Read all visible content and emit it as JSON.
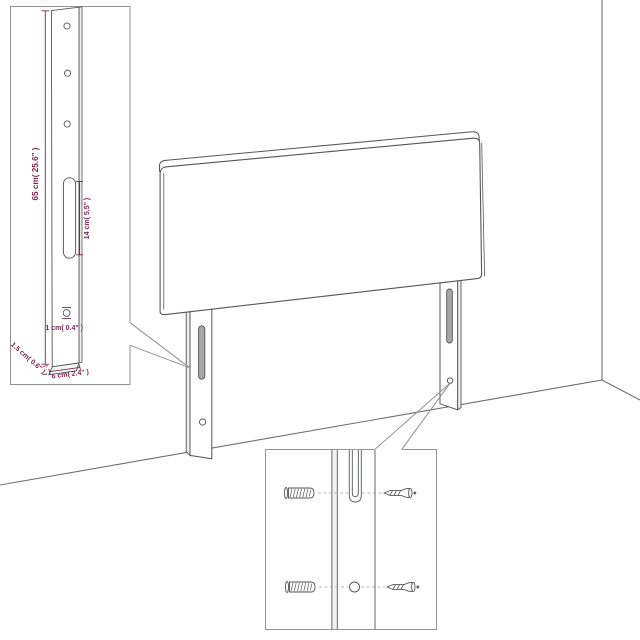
{
  "colors": {
    "background": "#ffffff",
    "object_line": "#55565a",
    "inset_border": "#919396",
    "callout_line": "#8f9194",
    "dimension": "#7c2950",
    "slot_fill": "#a8a8a8",
    "dashed_line": "#9b9b9b"
  },
  "leg_detail_inset": {
    "height_label": "65 cm( 25.6\" )",
    "slot_length_label": "14 cm( 5.5\" )",
    "hole_diameter_label": "1 cm( 0.4\" )",
    "thickness_label": "1.5 cm( 0.6\" )",
    "width_label": "6 cm( 2.4\" )"
  }
}
